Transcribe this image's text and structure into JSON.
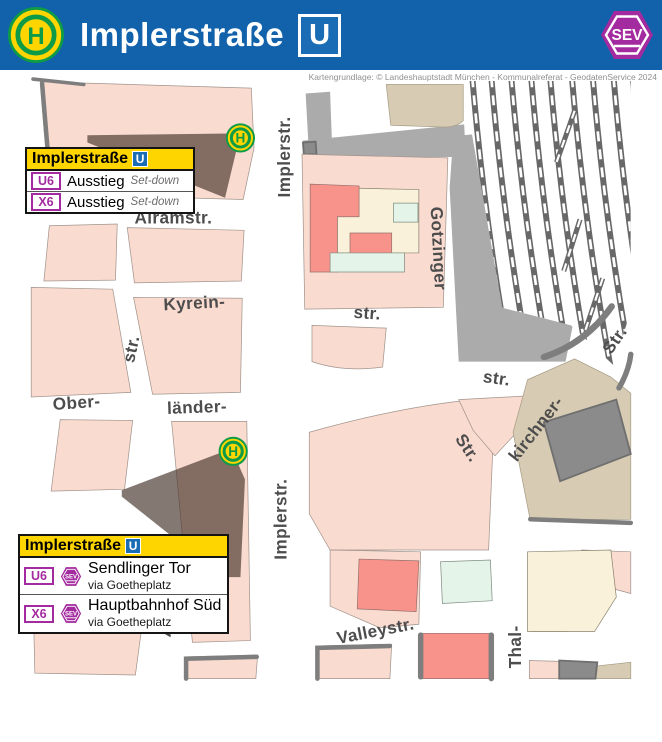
{
  "header": {
    "stop_sign": "H",
    "title": "Implerstraße",
    "u_badge": "U",
    "sev_badge": "SEV"
  },
  "attribution": "Kartengrundlage: © Landeshauptstadt München - Kommunalreferat - GeodatenService 2024",
  "map": {
    "stop_sign": "H",
    "street_labels": [
      {
        "text": "Implerstr.",
        "x": 279,
        "y": 166,
        "rot": -90
      },
      {
        "text": "Alramstr.",
        "x": 157,
        "y": 233,
        "rot": 0
      },
      {
        "text": "Kyrein-",
        "x": 180,
        "y": 327,
        "rot": -3
      },
      {
        "text": "str.",
        "x": 110,
        "y": 378,
        "rot": -78
      },
      {
        "text": "Ober-",
        "x": 50,
        "y": 437,
        "rot": -4
      },
      {
        "text": "länder-",
        "x": 183,
        "y": 442,
        "rot": -2
      },
      {
        "text": "Aberle-",
        "x": 153,
        "y": 662,
        "rot": -80
      },
      {
        "text": "Implerstr.",
        "x": 275,
        "y": 566,
        "rot": -90
      },
      {
        "text": "Gotzinger",
        "x": 450,
        "y": 267,
        "rot": 87
      },
      {
        "text": "str.",
        "x": 371,
        "y": 338,
        "rot": 4
      },
      {
        "text": "str.",
        "x": 514,
        "y": 410,
        "rot": 8
      },
      {
        "text": "Str.",
        "x": 644,
        "y": 368,
        "rot": -55
      },
      {
        "text": "kirchner-",
        "x": 557,
        "y": 466,
        "rot": -52
      },
      {
        "text": "Str.",
        "x": 482,
        "y": 487,
        "rot": 56
      },
      {
        "text": "Valleystr.",
        "x": 380,
        "y": 689,
        "rot": -11
      },
      {
        "text": "Thal-",
        "x": 534,
        "y": 707,
        "rot": -90
      }
    ]
  },
  "callouts": {
    "north": {
      "title": "Implerstraße",
      "u_badge": "U",
      "rows": [
        {
          "line": "U6",
          "text": "Ausstieg",
          "note": "Set-down"
        },
        {
          "line": "X6",
          "text": "Ausstieg",
          "note": "Set-down"
        }
      ]
    },
    "south": {
      "title": "Implerstraße",
      "u_badge": "U",
      "rows": [
        {
          "line": "U6",
          "sev": "SEV",
          "destination": "Sendlinger Tor",
          "via": "via Goetheplatz"
        },
        {
          "line": "X6",
          "sev": "SEV",
          "destination": "Hauptbahnhof Süd",
          "via": "via Goetheplatz"
        }
      ]
    }
  },
  "colors": {
    "header_blue": "#1161ab",
    "ubahn_blue": "#1a6cb5",
    "signal_yellow": "#ffd500",
    "stop_green": "#0d9b48",
    "sev_purple": "#a32a9f",
    "map_pink": "#fadbd0",
    "map_salmon": "#f8938c",
    "map_cream": "#f9f1d9",
    "map_green": "#e5f4e8",
    "map_tan": "#d7ccb3",
    "map_gray": "#ababab",
    "map_darkgray": "#8b8b8b",
    "label_gray": "#4d4d4d"
  }
}
